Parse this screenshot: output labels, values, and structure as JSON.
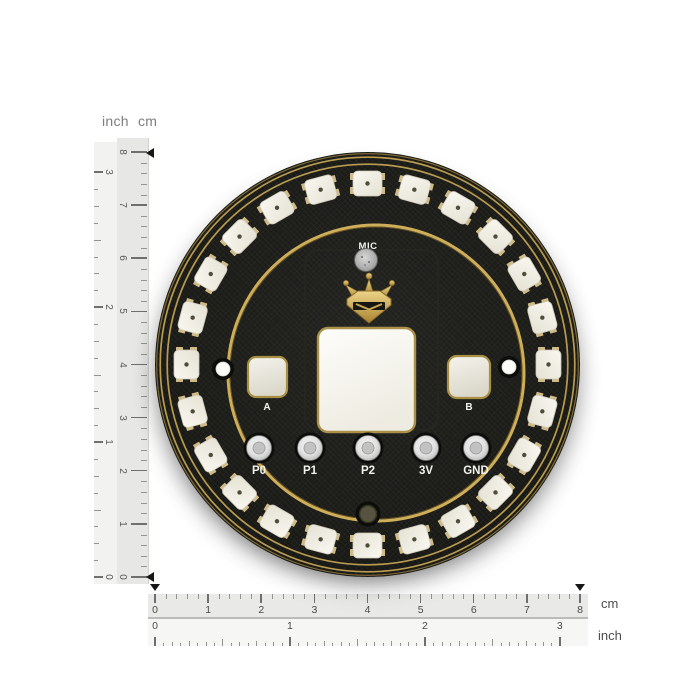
{
  "board": {
    "name": "circular RGB LED expansion board",
    "mic_label": "MIC",
    "button_a_label": "A",
    "button_b_label": "B",
    "pin_labels": [
      "P0",
      "P1",
      "P2",
      "3V",
      "GND"
    ],
    "led_count": 24,
    "colors": {
      "pcb_black": "#1b1b18",
      "gold": "#c9a855",
      "led_body": "#f3f1e8",
      "silkscreen_white": "#f3f3ee",
      "connector_silver": "#d9d9d9"
    }
  },
  "rulers": {
    "left": {
      "header_inch": "inch",
      "header_cm": "cm",
      "cm_values": [
        0,
        1,
        2,
        3,
        4,
        5,
        6,
        7,
        8
      ],
      "inch_values": [
        0,
        1,
        2,
        3
      ]
    },
    "bottom": {
      "cm_values": [
        0,
        1,
        2,
        3,
        4,
        5,
        6,
        7,
        8
      ],
      "inch_values": [
        0,
        1,
        2,
        3
      ],
      "cm_unit": "cm",
      "inch_unit": "inch"
    },
    "markers": {
      "board_span_cm": [
        0,
        8
      ]
    }
  }
}
